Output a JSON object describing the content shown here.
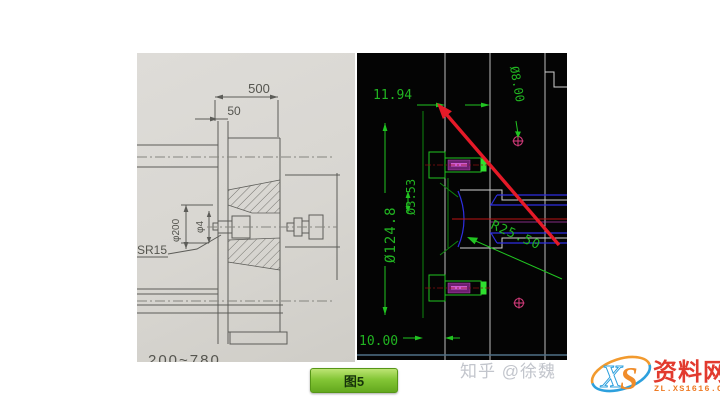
{
  "caption": {
    "label": "图5"
  },
  "left_drawing": {
    "dim_500": "500",
    "dim_50": "50",
    "dim_phi200": "φ200",
    "dim_phi4": "φ4",
    "label_sr15": "SR15",
    "bottom_range": "200~780"
  },
  "right_cad": {
    "dim_width": "11.94",
    "dim_hole": "Ø8.00",
    "dim_small": "Ø3.53",
    "dim_big": "Ø124.8",
    "dim_radius": "R25.50",
    "dim_offset": "10.00"
  },
  "watermark": {
    "zhihu": "知乎 @徐魏",
    "logo_x": "X",
    "logo_s": "S",
    "site": "资料网",
    "url": "ZL.XS1616.COM"
  },
  "colors": {
    "cad_dim_green": "#21b421",
    "cad_geometry_green": "#0e860e",
    "cad_shaft_blue": "#2e2ee0",
    "cad_centerline_red": "#bb1515",
    "annotation_arrow_red": "#e51a28",
    "marker_magenta": "#cf3a78",
    "caption_green": "#84c636",
    "paper_gray": "#d8d6d1"
  }
}
